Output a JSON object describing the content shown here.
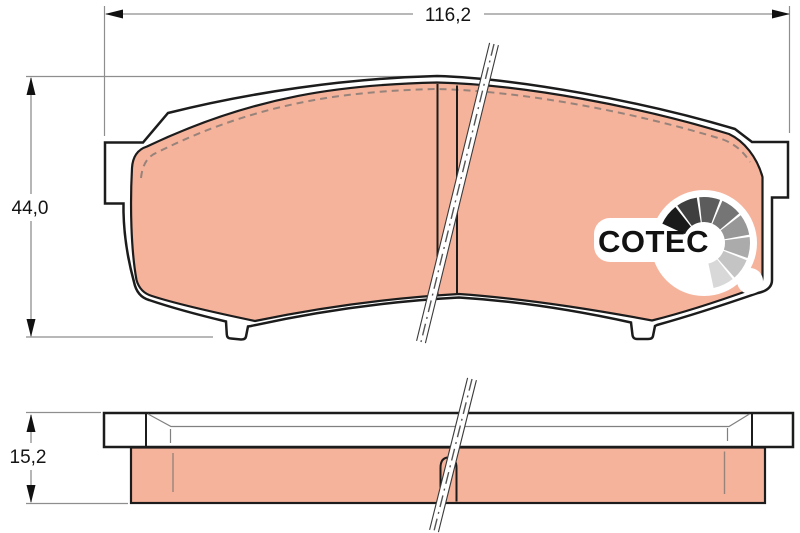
{
  "drawing": {
    "title": "brake-pad-technical-drawing",
    "dimensions": {
      "width_label": "116,2",
      "height_label": "44,0",
      "thickness_label": "15,2"
    },
    "logo": {
      "text": "COTEC",
      "fan_colors": [
        "#1a1a1a",
        "#3f3f3f",
        "#5c5c5c",
        "#757575",
        "#979797",
        "#ababab",
        "#c4c4c4",
        "#d8d8d8"
      ]
    },
    "colors": {
      "pad_fill": "#f6b39c",
      "outline": "#1c1c1c",
      "dim_line": "#8e8e8e",
      "arrow": "#111111",
      "chamfer_dash": "#97837a",
      "inner_gray": "#808080"
    }
  }
}
